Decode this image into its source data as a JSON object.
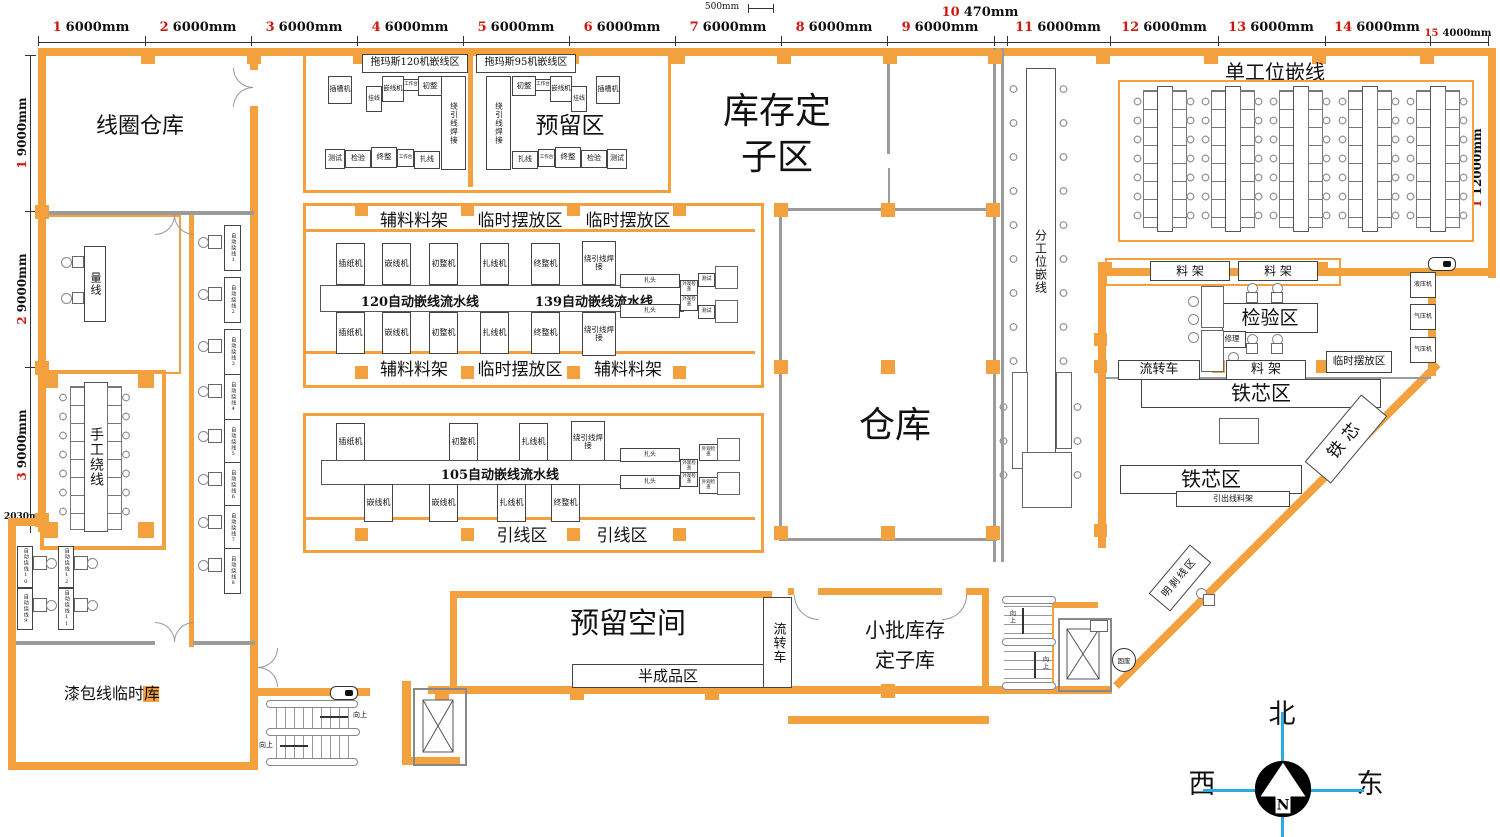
{
  "colors": {
    "wall": "#F3A13E",
    "red": "#D0190E",
    "blue": "#29ABE2",
    "gray": "#9B9B9B"
  },
  "ruler": {
    "top": [
      {
        "n": "1",
        "d": "6000mm"
      },
      {
        "n": "2",
        "d": "6000mm"
      },
      {
        "n": "3",
        "d": "6000mm"
      },
      {
        "n": "4",
        "d": "6000mm"
      },
      {
        "n": "5",
        "d": "6000mm"
      },
      {
        "n": "6",
        "d": "6000mm"
      },
      {
        "n": "7",
        "d": "6000mm"
      },
      {
        "n": "8",
        "d": "6000mm"
      },
      {
        "n": "9",
        "d": "6000mm"
      },
      {
        "n": "10",
        "d": "470mm"
      },
      {
        "n": "11",
        "d": "6000mm"
      },
      {
        "n": "12",
        "d": "6000mm"
      },
      {
        "n": "13",
        "d": "6000mm"
      },
      {
        "n": "14",
        "d": "6000mm"
      },
      {
        "n": "15",
        "d": "4000mm"
      }
    ],
    "small": "500mm",
    "left": [
      {
        "n": "1",
        "d": "9000mm"
      },
      {
        "n": "2",
        "d": "9000mm"
      },
      {
        "n": "3",
        "d": "9000mm"
      }
    ],
    "offset": "2030mm",
    "right": {
      "n": "1",
      "d": "12000mm"
    }
  },
  "areas": {
    "coil_warehouse": "线圈仓库",
    "measuring": "量线",
    "manual_winding": "手工绕线",
    "enamel_temp": "漆包线临时库",
    "thomas120": "拖玛斯120机嵌线区",
    "thomas95": "拖玛斯95机嵌线区",
    "reserved": "预留区",
    "stock_stator_1": "库存定",
    "stock_stator_2": "子区",
    "warehouse": "仓库",
    "multi_station": "分工位嵌线",
    "single_station": "单工位嵌线",
    "reserved_space": "预留空间",
    "semi_finished": "半成品区",
    "transfer_cart": "流转车",
    "small_batch_1": "小批库存",
    "small_batch_2": "定子库",
    "inspection": "检验区",
    "repair": "修理",
    "hydraulic": "液压机",
    "pneumatic": "气压机",
    "rack2": "料 架",
    "temp_area": "临时摆放区",
    "core_area": "铁芯区",
    "core": "铁芯",
    "lead_rack": "引出线料架",
    "strip_area": "明剥线区",
    "solid_waste": "固废",
    "up": "向上"
  },
  "strips": {
    "r1": [
      "辅料料架",
      "临时摆放区",
      "临时摆放区"
    ],
    "r2": [
      "辅料料架",
      "临时摆放区",
      "辅料料架"
    ],
    "r3": [
      "引线区",
      "引线区"
    ]
  },
  "lines": {
    "belt120": "120自动嵌线流水线",
    "belt139": "139自动嵌线流水线",
    "belt105": "105自动嵌线流水线",
    "row": [
      "插纸机",
      "嵌线机",
      "初整机",
      "扎线机",
      "终整机",
      "绕引线焊接"
    ],
    "l105_top": [
      "插纸机",
      "初整机",
      "扎线机",
      "绕引线焊接"
    ],
    "l105_bot": [
      "嵌线机",
      "嵌线机",
      "扎线机",
      "终整机"
    ],
    "zhatou": "扎头",
    "inspect": "外观检查",
    "test": "测试"
  },
  "thomas": {
    "c1_top": [
      "插槽机",
      "挂线",
      "嵌线机",
      "工作台",
      "初整"
    ],
    "weld": "绕引线焊接",
    "c1_bot": [
      "测试",
      "检验",
      "终整",
      "工作台",
      "扎线"
    ],
    "c2_top": [
      "初整",
      "工作台",
      "嵌线机",
      "挂线",
      "插槽机"
    ],
    "c2_bot": [
      "扎线",
      "工作台",
      "终整",
      "检验",
      "测试"
    ]
  },
  "autowind": [
    "自动绕线1",
    "自动绕线2",
    "自动绕线3",
    "自动绕线4",
    "自动绕线5",
    "自动绕线6",
    "自动绕线7",
    "自动绕线8",
    "自动绕线10",
    "自动绕线12",
    "自动绕线9",
    "自动绕线11"
  ],
  "compass": {
    "north": "北",
    "west": "西",
    "east": "东",
    "n": "N"
  }
}
